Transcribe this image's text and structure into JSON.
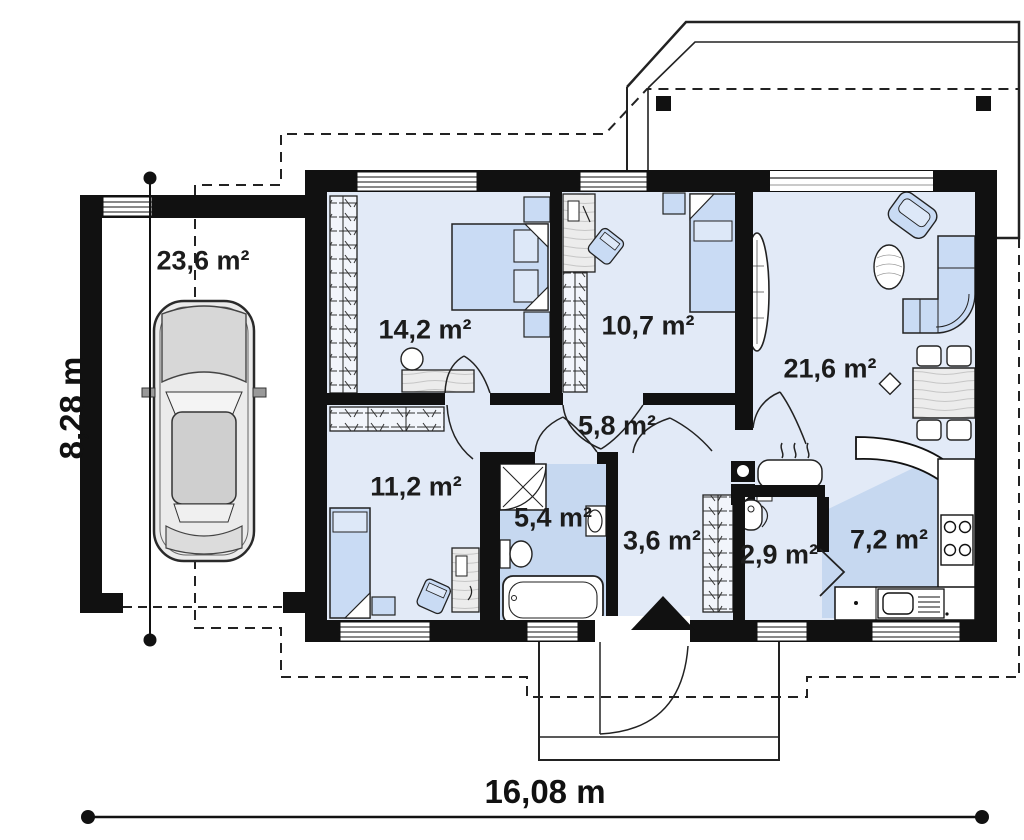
{
  "plan": {
    "rooms": [
      {
        "id": "garage",
        "label": "23,6 m²"
      },
      {
        "id": "bedroom-1",
        "label": "14,2 m²"
      },
      {
        "id": "bedroom-2",
        "label": "10,7 m²"
      },
      {
        "id": "living-room",
        "label": "21,6 m²"
      },
      {
        "id": "hall",
        "label": "5,8 m²"
      },
      {
        "id": "bedroom-3",
        "label": "11,2 m²"
      },
      {
        "id": "bathroom",
        "label": "5,4 m²"
      },
      {
        "id": "entry",
        "label": "3,6 m²"
      },
      {
        "id": "utility",
        "label": "2,9 m²"
      },
      {
        "id": "kitchen",
        "label": "7,2 m²"
      }
    ],
    "dimensions": {
      "width_label": "16,08 m",
      "height_label": "8,28 m"
    },
    "colors": {
      "wall": "#111111",
      "floor": "#e2eaf7",
      "floor_accent": "#c6d8f0",
      "furniture": "#c9dbf4",
      "outline": "#222222"
    }
  }
}
